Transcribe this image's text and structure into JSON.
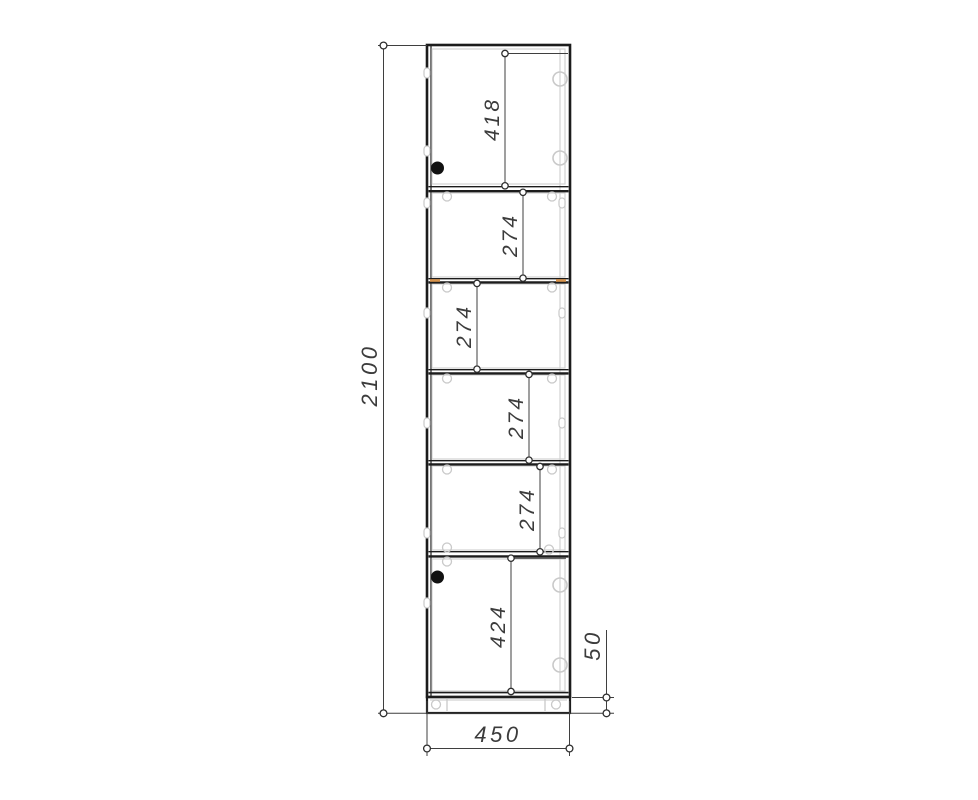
{
  "drawing": {
    "kind": "furniture-front-elevation",
    "subject": "tall-cabinet",
    "dimensions": {
      "overall_height": "2100",
      "overall_width": "450",
      "plinth_height": "50",
      "section_heights": [
        "418",
        "274",
        "274",
        "274",
        "274",
        "424"
      ]
    },
    "icons": {
      "door_knob": "door-knob-icon",
      "hinge_cup": "hinge-cup-icon",
      "cam_fitting": "cam-fitting-icon",
      "leg_leveler": "leg-leveler-icon"
    },
    "colors": {
      "background": "#ffffff",
      "outline_dark": "#1c1c1c",
      "dimension_line": "#3f3f3f",
      "dimension_text": "#3c3c3c",
      "hardware_gray": "#c9c9c9",
      "panel_gray": "#d2d2d2",
      "edge_mark_orange": "#d8944d",
      "knob_black": "#111111"
    }
  }
}
